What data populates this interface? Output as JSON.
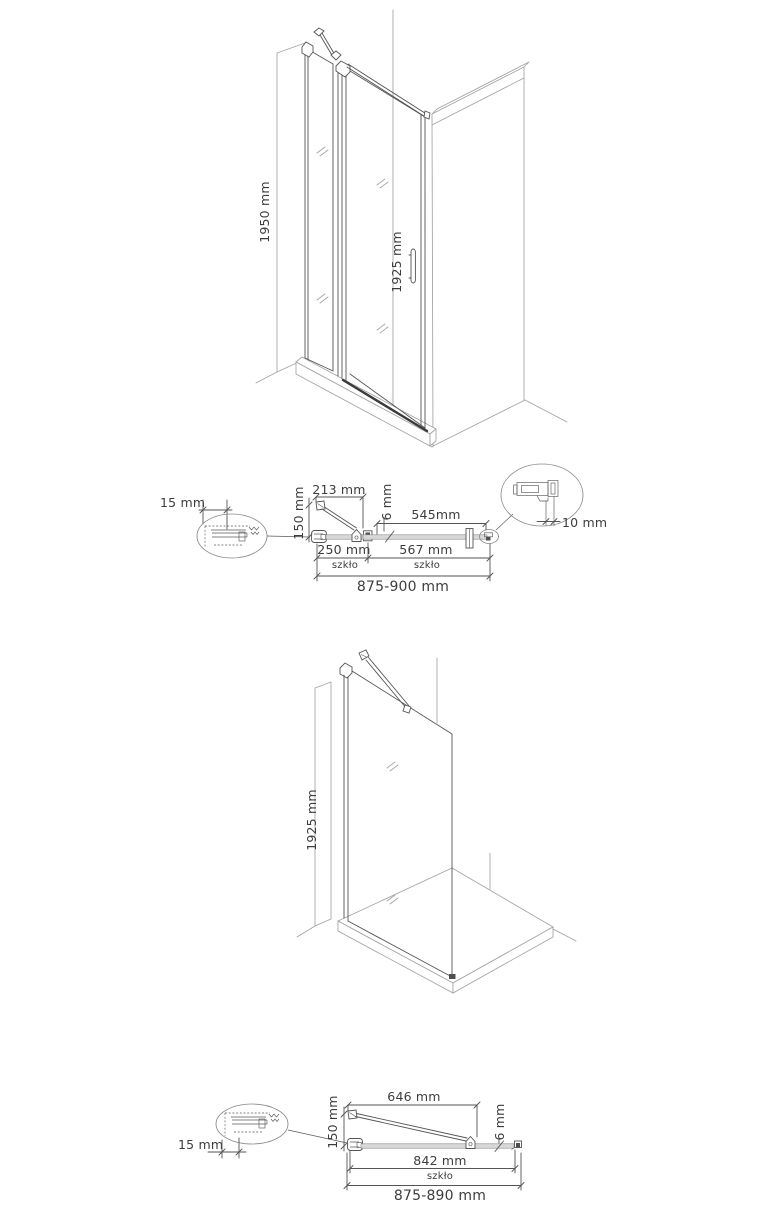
{
  "door_diagram": {
    "wall_height": "1950 mm",
    "glass_height": "1925 mm"
  },
  "door_section": {
    "wall_profile_depth": "15 mm",
    "bar_length": "213 mm",
    "bar_offset": "150 mm",
    "glass_thickness": "6 mm",
    "door_width": "545mm",
    "bracket_gap": "10 mm",
    "fixed_glass_width": "250 mm",
    "fixed_glass_material": "szkło",
    "door_glass_width": "567 mm",
    "door_glass_material": "szkło",
    "total_width": "875-900 mm"
  },
  "panel_diagram": {
    "glass_height": "1925 mm"
  },
  "panel_section": {
    "wall_profile_depth": "15 mm",
    "bar_length": "646 mm",
    "bar_offset": "150 mm",
    "glass_thickness": "6 mm",
    "glass_width": "842 mm",
    "glass_material": "szkło",
    "total_width": "875-890 mm"
  },
  "colors": {
    "line": "#555555",
    "light_line": "#a3a3a3",
    "glass_fill": "#d8d8d8",
    "text": "#3d3d3d"
  }
}
